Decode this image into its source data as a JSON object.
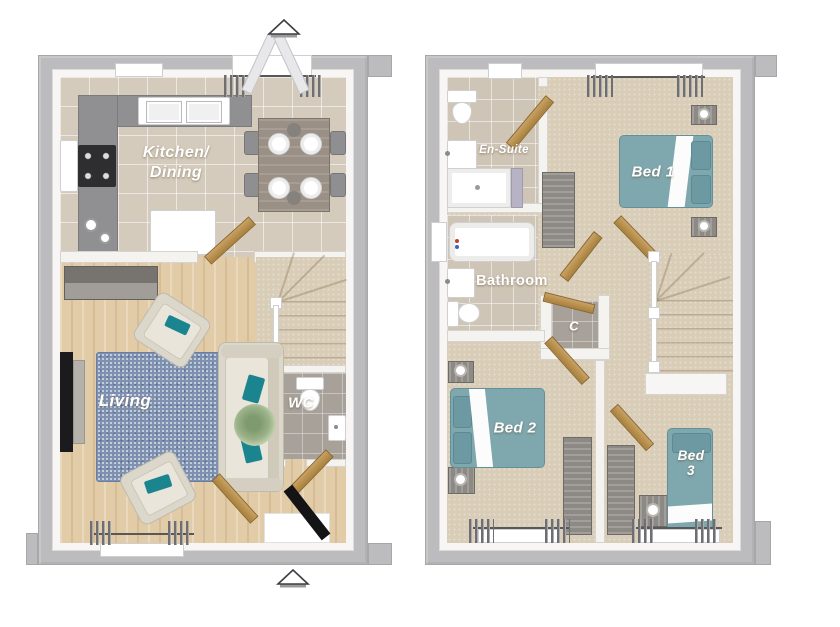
{
  "scene": {
    "type": "3d-floorplan-pair",
    "background": "#ffffff"
  },
  "colors": {
    "outer_wall": "#bcbcbe",
    "inner_wall": "#f7f6f4",
    "kitchen_tile": "#d5cbbc",
    "wood_floor": "#e2cba7",
    "carpet": "#d9cdb8",
    "gray_tile": "#a8a199",
    "bed_teal": "#7fa7ae",
    "accent_teal": "#1b858f",
    "rug_blue": "#7e91b1",
    "door_wood": "#b8924f",
    "furniture_gray": "#8d8985",
    "label_text": "#ffffff"
  },
  "ground_floor": {
    "name": "Ground floor",
    "rooms": [
      {
        "id": "kitchen-dining",
        "label_lines": [
          "Kitchen/",
          "Dining"
        ],
        "furniture": [
          "kitchen-counter",
          "double-sink",
          "hob-oven",
          "dishwasher",
          "dining-table",
          "chairs",
          "window",
          "french-doors"
        ]
      },
      {
        "id": "living",
        "label": "Living",
        "furniture": [
          "sofa",
          "armchair",
          "armchair",
          "rug",
          "tv",
          "sideboard",
          "plant",
          "window"
        ]
      },
      {
        "id": "wc",
        "label": "WC",
        "furniture": [
          "toilet",
          "basin"
        ]
      },
      {
        "id": "hall",
        "furniture": [
          "staircase",
          "front-door",
          "internal-doors"
        ]
      }
    ],
    "markers": [
      "entrance-arrow-top",
      "entrance-arrow-bottom"
    ]
  },
  "first_floor": {
    "name": "First floor",
    "rooms": [
      {
        "id": "en-suite",
        "label": "En-Suite",
        "furniture": [
          "toilet",
          "basin",
          "shower",
          "window"
        ]
      },
      {
        "id": "bed-1",
        "label": "Bed 1",
        "furniture": [
          "double-bed",
          "nightstand",
          "nightstand",
          "wardrobe",
          "window"
        ]
      },
      {
        "id": "bathroom",
        "label": "Bathroom",
        "furniture": [
          "bath",
          "basin",
          "toilet",
          "window"
        ]
      },
      {
        "id": "cupboard",
        "label": "C"
      },
      {
        "id": "bed-2",
        "label": "Bed 2",
        "furniture": [
          "double-bed",
          "nightstand",
          "nightstand",
          "wardrobe",
          "window"
        ]
      },
      {
        "id": "bed-3",
        "label_lines": [
          "Bed",
          "3"
        ],
        "furniture": [
          "single-bed",
          "nightstand",
          "wardrobe",
          "window"
        ]
      },
      {
        "id": "landing",
        "furniture": [
          "staircase"
        ]
      }
    ]
  }
}
